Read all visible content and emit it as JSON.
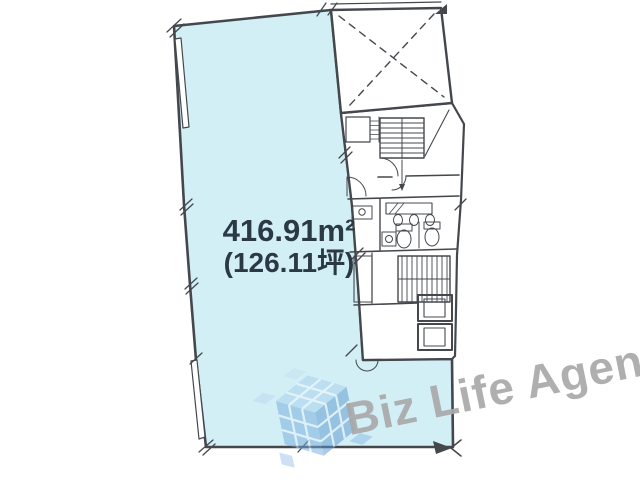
{
  "floor_plan": {
    "area_label": {
      "square_meters": "416.91m²",
      "tsubo": "(126.11坪)"
    },
    "colors": {
      "floor_fill": "#d3eff6",
      "wall_line": "#44484d",
      "area_text": "#2b3947",
      "watermark_text_gray": "#a9a9a9",
      "watermark_logo_blue": "#6fa9dc"
    }
  },
  "watermark": {
    "brand": "Biz Life Agent",
    "logo": "isometric-cube-tiles"
  }
}
